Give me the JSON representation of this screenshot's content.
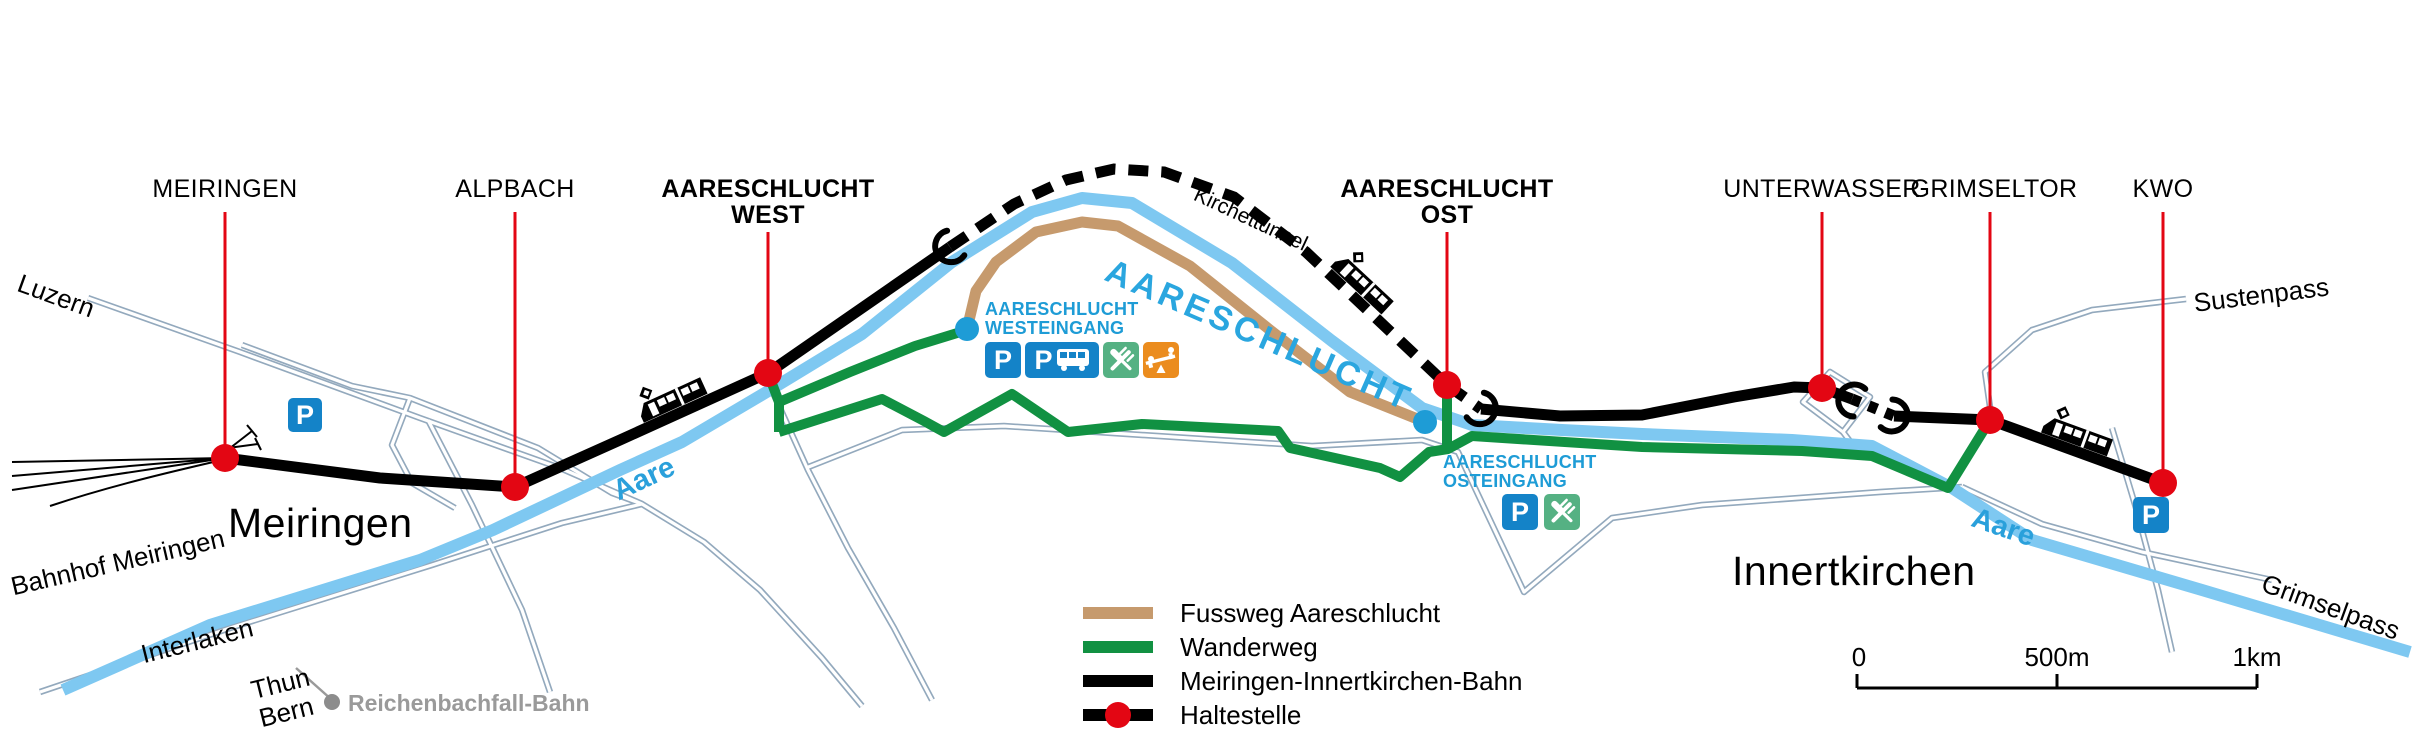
{
  "map": {
    "stations": [
      {
        "name": "MEIRINGEN"
      },
      {
        "name": "ALPBACH"
      },
      {
        "name": "AARESCHLUCHT",
        "sub": "WEST"
      },
      {
        "name": "AARESCHLUCHT",
        "sub": "OST"
      },
      {
        "name": "UNTERWASSER"
      },
      {
        "name": "GRIMSELTOR"
      },
      {
        "name": "KWO"
      }
    ],
    "entrances": {
      "west": {
        "line1": "AARESCHLUCHT",
        "line2": "WESTEINGANG"
      },
      "east": {
        "line1": "AARESCHLUCHT",
        "line2": "OSTEINGANG"
      }
    },
    "places": {
      "meiringen": "Meiringen",
      "innertkirchen": "Innertkirchen",
      "bahnhof_meiringen": "Bahnhof Meiringen",
      "luzern": "Luzern",
      "interlaken": "Interlaken",
      "thun": "Thun",
      "bern": "Bern",
      "reichenbach": "Reichenbachfall-Bahn",
      "sustenpass": "Sustenpass",
      "grimselpass": "Grimselpass",
      "aare_west": "Aare",
      "aare_east": "Aare",
      "gorge": "AARESCHLUCHT",
      "kirchettunnel": "Kirchettunnel"
    },
    "icons": {
      "parking": "P"
    },
    "legend": [
      {
        "label": "Fussweg Aareschlucht",
        "color": "#C69A6D"
      },
      {
        "label": "Wanderweg",
        "color": "#119142"
      },
      {
        "label": "Meiringen-Innertkirchen-Bahn",
        "color": "#000000"
      },
      {
        "label": "Haltestelle",
        "color": "#000000",
        "dot_color": "#E30613"
      }
    ],
    "scalebar": {
      "start": "0",
      "mid": "500m",
      "end": "1km"
    },
    "colors": {
      "stop_red": "#E30613",
      "rail_black": "#000000",
      "river_blue": "#7EC8F1",
      "fussweg_tan": "#C69A6D",
      "wanderweg_green": "#119142",
      "road_gray": "#93A9BD",
      "entrance_blue": "#1E9CD6",
      "parking_blue": "#1483C8",
      "restaurant_green": "#55B183",
      "playground_orange": "#EB8C1E",
      "reichenbach_gray": "#9A9A9A"
    }
  }
}
